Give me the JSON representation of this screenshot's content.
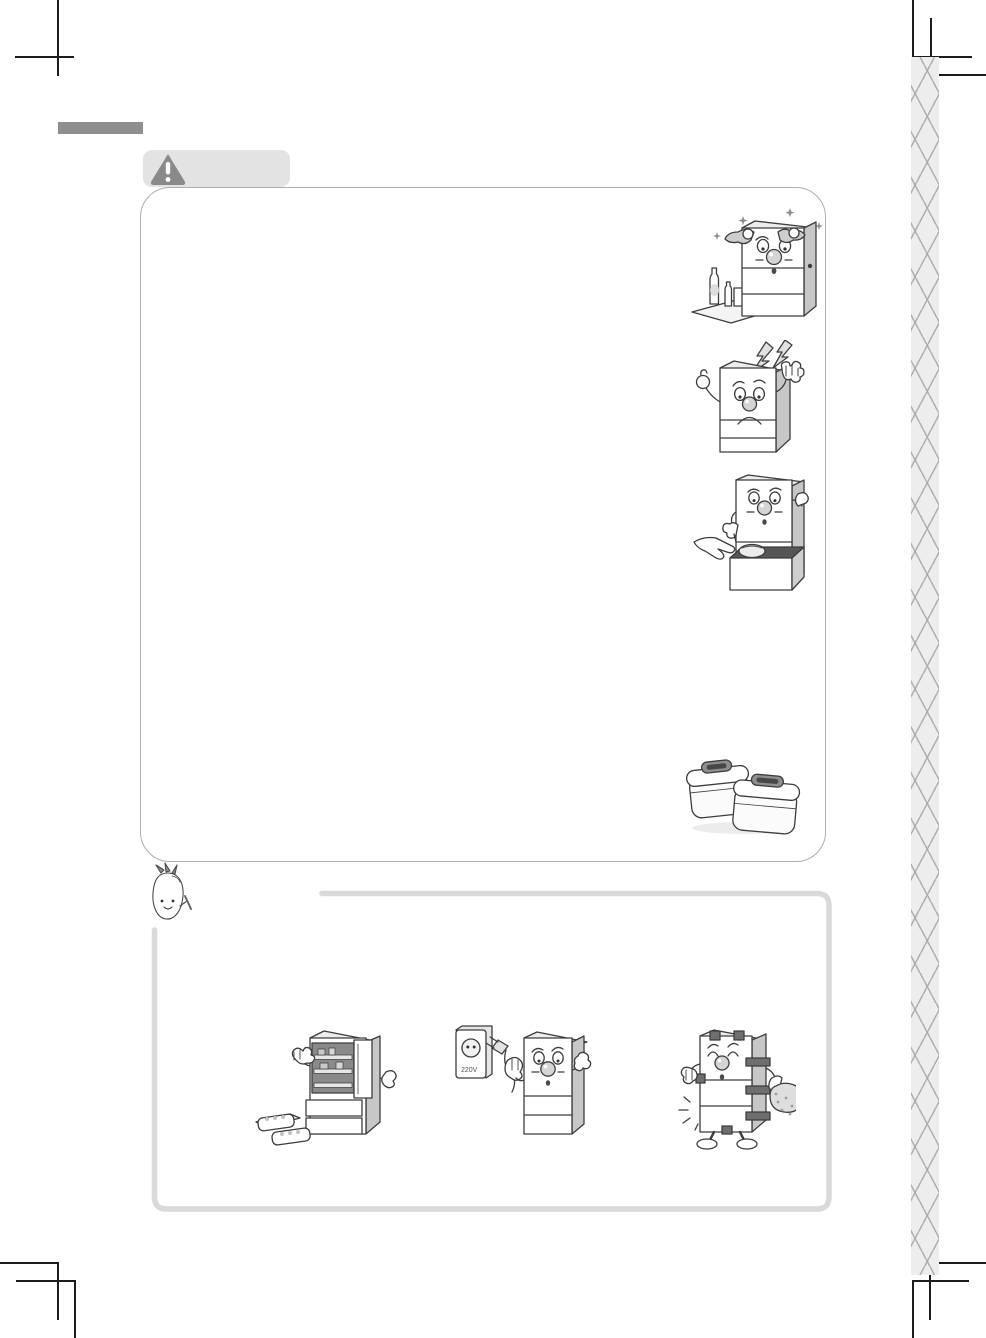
{
  "page": {
    "kind": "appliance-manual-page",
    "background": "#ffffff"
  },
  "decorations": {
    "section_bar_color": "#8f8f8f",
    "trim_mark_color": "#1c1c1c",
    "binding_strip": {
      "bg": "#ededed",
      "line": "#a5a5a5"
    }
  },
  "caution_section": {
    "tab": {
      "bg": "#e3e3e3",
      "icon": "warning-triangle-icon",
      "icon_color": "#8a8a8a"
    },
    "box_border": "#aeaeae",
    "illustrations": [
      {
        "id": "fridge-polishing",
        "alt": "happy fridge wiping itself with cloths, sparkles, bottles on a mat"
      },
      {
        "id": "fridge-lightning",
        "alt": "worried fridge with lightning bolts warning of electric shock"
      },
      {
        "id": "fridge-drawer-food",
        "alt": "hand placing a food container into the open lower drawer"
      },
      {
        "id": "kimchi-containers",
        "alt": "two kimchi storage containers with handles"
      }
    ]
  },
  "note_section": {
    "mascot": {
      "id": "radish-mascot",
      "alt": "small radish character with leaf sprout"
    },
    "box_border": "#d9d9d9",
    "illustrations": [
      {
        "id": "fridge-open-door-trays",
        "alt": "fridge with upper door open showing shelves, trays on floor"
      },
      {
        "id": "fridge-power-plug",
        "alt": "fridge holding its power plug next to a wall outlet",
        "outlet_label": "220V"
      },
      {
        "id": "fridge-taped-moving",
        "alt": "fridge taped up for moving, carrying a sack"
      }
    ]
  }
}
